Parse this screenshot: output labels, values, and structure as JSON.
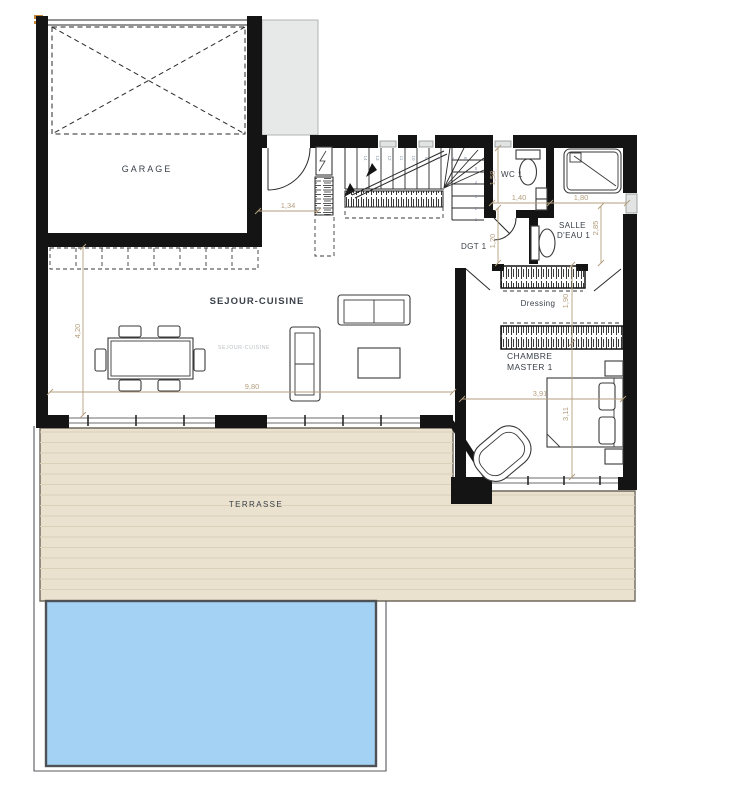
{
  "plan": {
    "rooms": {
      "garage": "GARAGE",
      "sejour": "SEJOUR-CUISINE",
      "sejour_small": "SEJOUR-CUISINE",
      "terrasse": "TERRASSE",
      "wc": "WC 1",
      "salle_deau_l1": "SALLE",
      "salle_deau_l2": "D'EAU 1",
      "dgt": "DGT 1",
      "dressing": "Dressing",
      "chambre_l1": "CHAMBRE",
      "chambre_l2": "MASTER 1"
    },
    "dimensions": {
      "d134": "1,34",
      "d158": "1,58",
      "d140": "1,40",
      "d180": "1,80",
      "d285": "2,85",
      "d120": "1,20",
      "d190": "1,90",
      "d420": "4,20",
      "d980": "9,80",
      "d391": "3,91",
      "d311": "3,11"
    },
    "stairs": {
      "steps": [
        "1",
        "2",
        "3",
        "4",
        "5",
        "6",
        "7",
        "8",
        "9",
        "10",
        "11",
        "12",
        "13",
        "14"
      ]
    },
    "colors": {
      "wall": "#141414",
      "terrace": "#EAE1CE",
      "terrace_line": "#DBD0B8",
      "pool": "#A4D2F4",
      "pool_border": "#50545A",
      "porch": "#E7E9E8",
      "dim": "#B49F7F",
      "label": "#3A4149",
      "label_light": "#B9BDC1",
      "step_number": "#8A97AD",
      "accent": "#C98636"
    }
  }
}
